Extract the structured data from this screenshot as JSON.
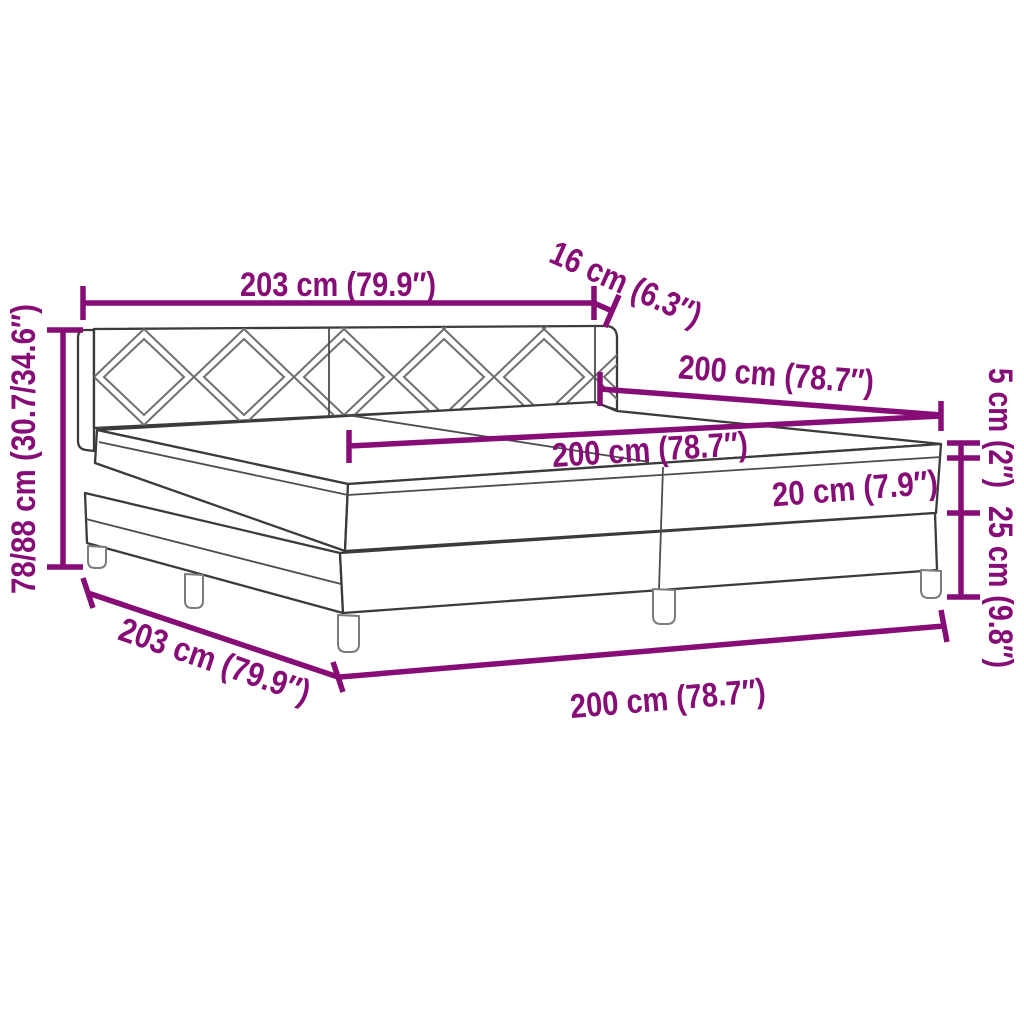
{
  "figure": {
    "kind": "product dimension diagram",
    "subject": "box spring bed with diamond-pattern headboard, two-piece mattress and legs"
  },
  "colors": {
    "dimension_accent": "#870d76",
    "drawing_outline": "#3b3b3b",
    "pattern_line": "#6f6f6f",
    "background": "#ffffff"
  },
  "dimensions": {
    "headboard_width": "203 cm (79.9″)",
    "headboard_depth": "16 cm (6.3″)",
    "bed_length_top": "200 cm (78.7″)",
    "mattress_width": "200 cm (78.7″)",
    "mattress_height": "20 cm (7.9″)",
    "topper_height": "5 cm (2″)",
    "base_height": "25 cm (9.8″)",
    "total_height": "78/88 cm (30.7/34.6″)",
    "frame_length": "203 cm (79.9″)",
    "bed_length_bottom": "200 cm (78.7″)"
  }
}
